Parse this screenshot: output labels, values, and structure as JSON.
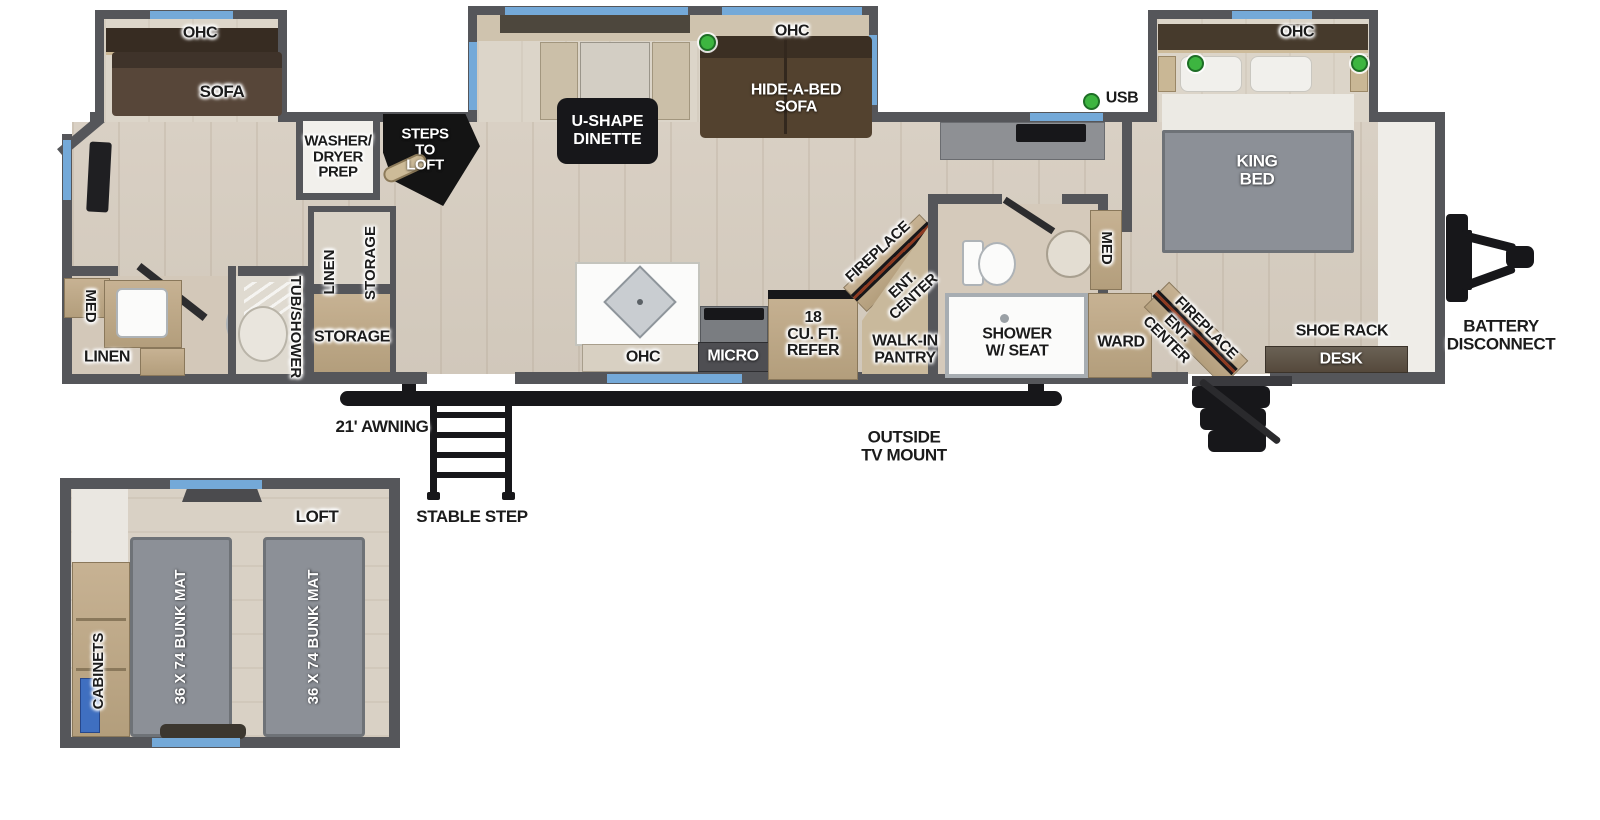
{
  "slides": {
    "rear": {
      "ohc": "OHC",
      "sofa": "SOFA"
    },
    "dinette": {
      "label": "U-SHAPE\nDINETTE",
      "ohc": "OHC",
      "hide_a_bed": "HIDE-A-BED\nSOFA"
    },
    "king": {
      "ohc": "OHC"
    }
  },
  "living": {
    "washer_dryer_prep": "WASHER/\nDRYER\nPREP",
    "steps_to_loft": "STEPS\nTO\nLOFT",
    "linen": "LINEN",
    "storage_upper": "STORAGE",
    "storage_lower": "STORAGE"
  },
  "rear_bath": {
    "med": "MED",
    "linen": "LINEN",
    "tub_shower": "TUB/SHOWER"
  },
  "kitchen": {
    "ohc": "OHC",
    "micro": "MICRO",
    "refer": "18\nCU. FT.\nREFER",
    "fireplace": "FIREPLACE",
    "ent_center": "ENT.\nCENTER",
    "pantry": "WALK-IN\nPANTRY"
  },
  "mid_bath": {
    "shower": "SHOWER\nW/ SEAT",
    "med": "MED"
  },
  "bedroom": {
    "usb": "USB",
    "king_bed": "KING\nBED",
    "ward": "WARD",
    "ent_center": "ENT.\nCENTER",
    "fireplace": "FIREPLACE",
    "shoe_rack": "SHOE RACK",
    "desk": "DESK"
  },
  "exterior": {
    "battery_disconnect": "BATTERY\nDISCONNECT",
    "awning": "21' AWNING",
    "outside_tv": "OUTSIDE\nTV MOUNT",
    "stable_step": "STABLE STEP"
  },
  "loft": {
    "title": "LOFT",
    "cabinets": "CABINETS",
    "bunk_left": "36 X 74 BUNK MAT",
    "bunk_right": "36 X 74 BUNK MAT"
  },
  "colors": {
    "wall": "#55565a",
    "window": "#74a9d8",
    "usb_green": "#3db540",
    "fireplace_stripe": "#8d3b22"
  }
}
